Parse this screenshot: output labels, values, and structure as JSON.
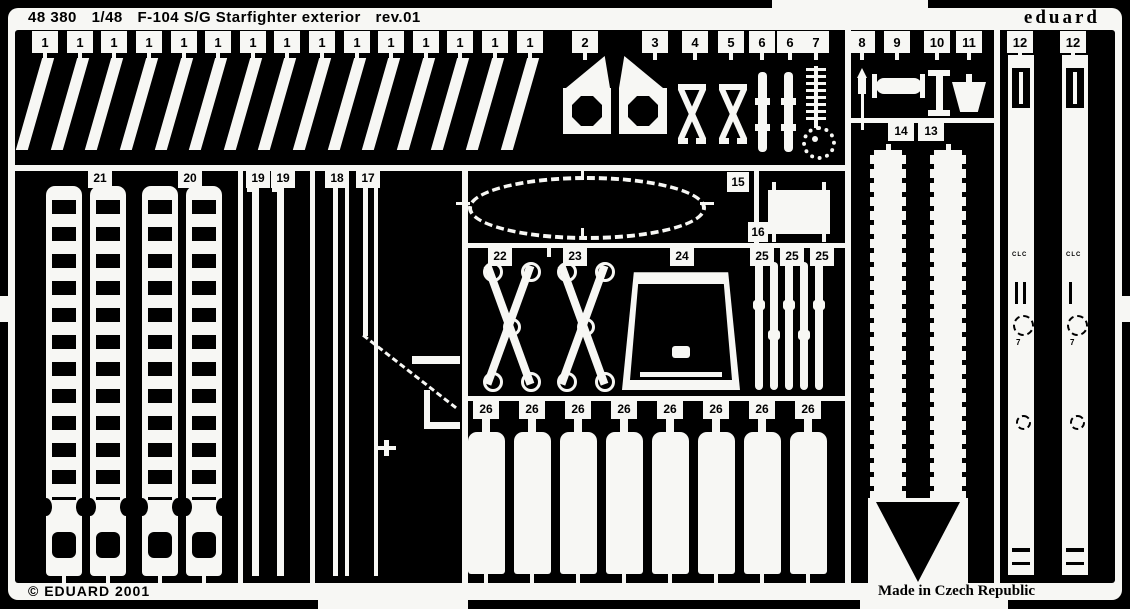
{
  "header": {
    "catalog_number": "48 380",
    "scale": "1/48",
    "title": "F-104 S/G Starfighter exterior",
    "revision": "rev.01",
    "brand": "eduard"
  },
  "footer": {
    "copyright": "© EDUARD 2001",
    "made_in": "Made in Czech Republic"
  },
  "part_numbers": {
    "top_row": [
      "1",
      "1",
      "1",
      "1",
      "1",
      "1",
      "1",
      "1",
      "1",
      "1",
      "1",
      "1",
      "1",
      "1",
      "1",
      "2",
      "3",
      "4",
      "5",
      "6",
      "6",
      "7",
      "8",
      "9",
      "10",
      "11",
      "12",
      "12"
    ],
    "left_section": [
      "21",
      "20",
      "19",
      "19",
      "18",
      "17"
    ],
    "middle_top": [
      "15",
      "16"
    ],
    "middle_row": [
      "22",
      "23",
      "24",
      "25",
      "25",
      "25"
    ],
    "right_section": [
      "14",
      "13"
    ],
    "bottom_row": [
      "26",
      "26",
      "26",
      "26",
      "26",
      "26",
      "26",
      "26"
    ]
  },
  "etched_marks": {
    "strip_12_left": "CLC",
    "strip_12_right": "CLC",
    "strip_12_left_num": "7",
    "strip_12_right_num": "7"
  },
  "colors": {
    "metal": "#f7f7f4",
    "background": "#000000"
  }
}
